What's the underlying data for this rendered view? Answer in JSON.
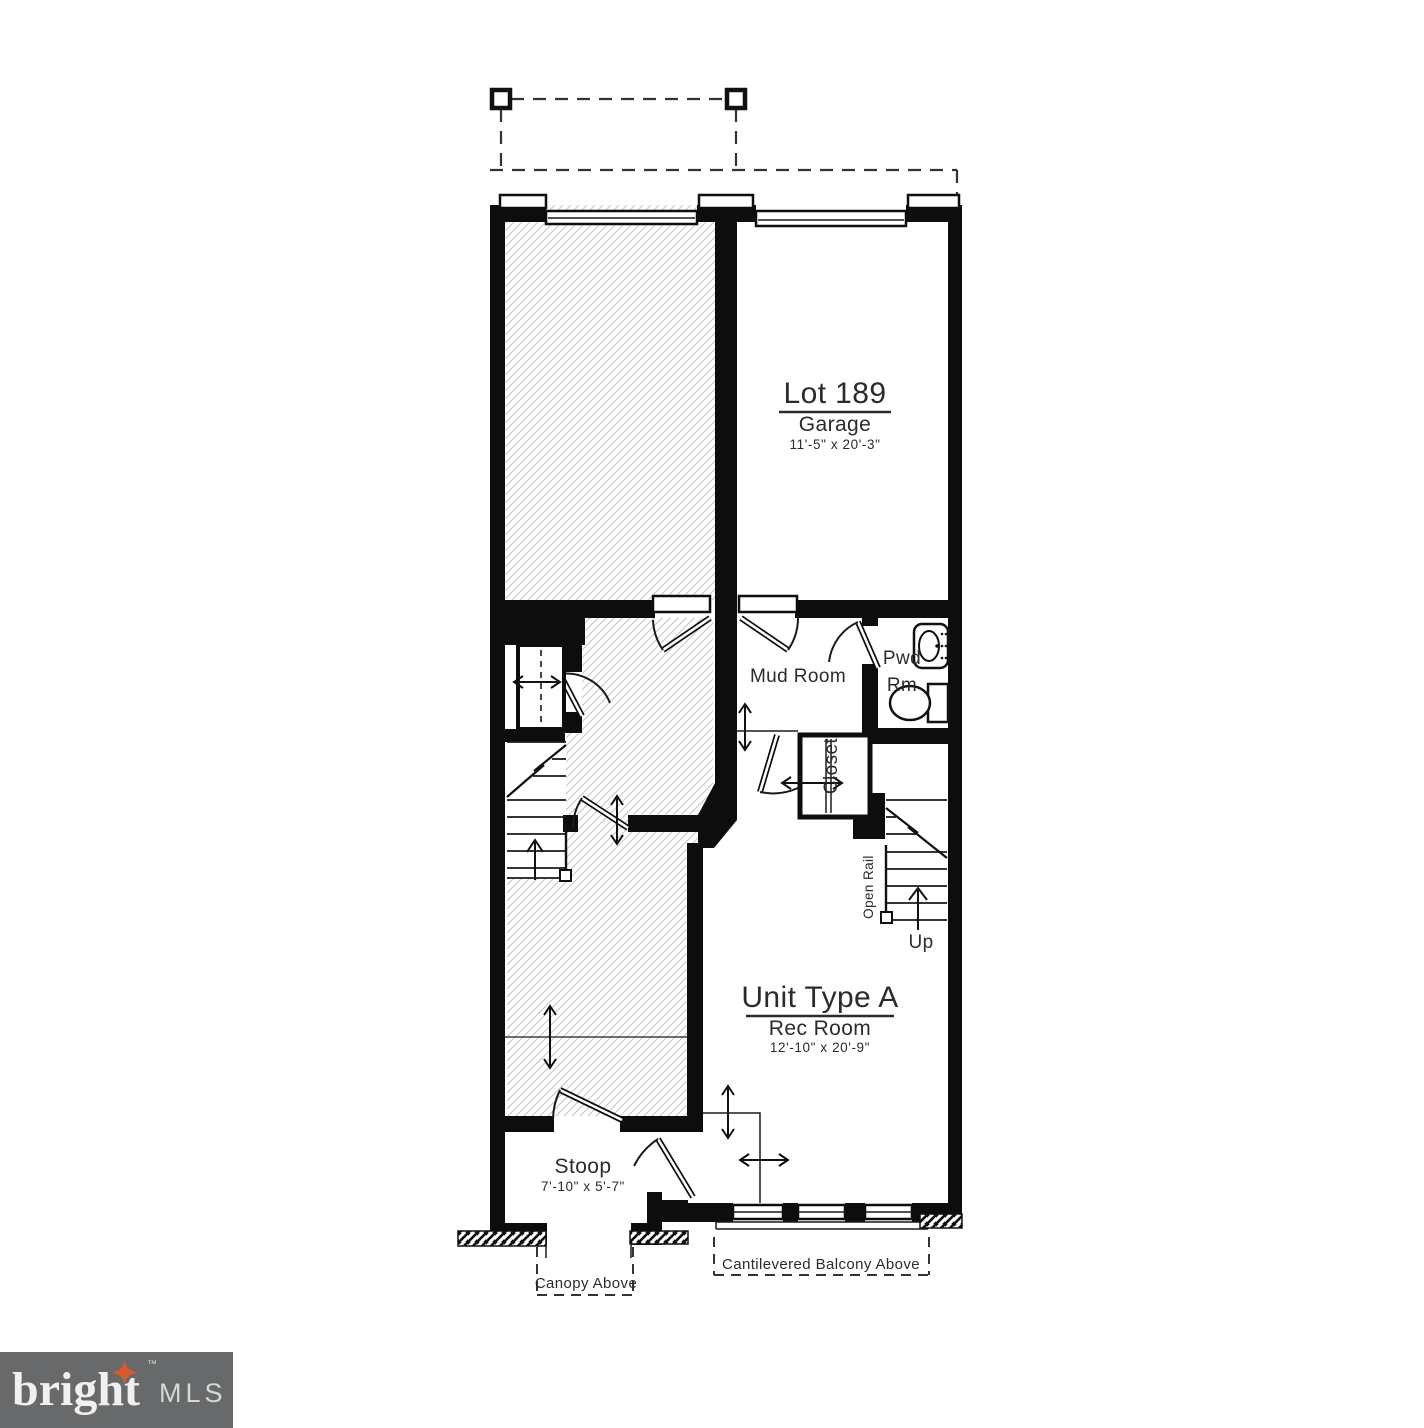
{
  "plan": {
    "lot": {
      "title": "Lot 189",
      "room": "Garage",
      "dims": "11'-5\" x 20'-3\""
    },
    "unit": {
      "title": "Unit Type A",
      "room": "Rec Room",
      "dims": "12'-10\" x 20'-9\""
    },
    "mud_room": "Mud Room",
    "powder_room_line1": "Pwd",
    "powder_room_line2": "Rm",
    "closet": "Closet",
    "open_rail": "Open Rail",
    "up": "Up",
    "stoop": {
      "title": "Stoop",
      "dims": "7'-10\" x 5'-7\""
    },
    "canopy": "Canopy Above",
    "balcony": "Cantilevered Balcony Above"
  },
  "logo": {
    "brand": "bright",
    "tm": "™",
    "suffix": "MLS"
  },
  "colors": {
    "ink": "#0d0d0d",
    "hatch": "#c6c6c6",
    "logo_bg": "#68696b",
    "logo_accent": "#d85b2b",
    "logo_text": "#f1f0ee",
    "logo_suffix": "#d6d7d7"
  }
}
